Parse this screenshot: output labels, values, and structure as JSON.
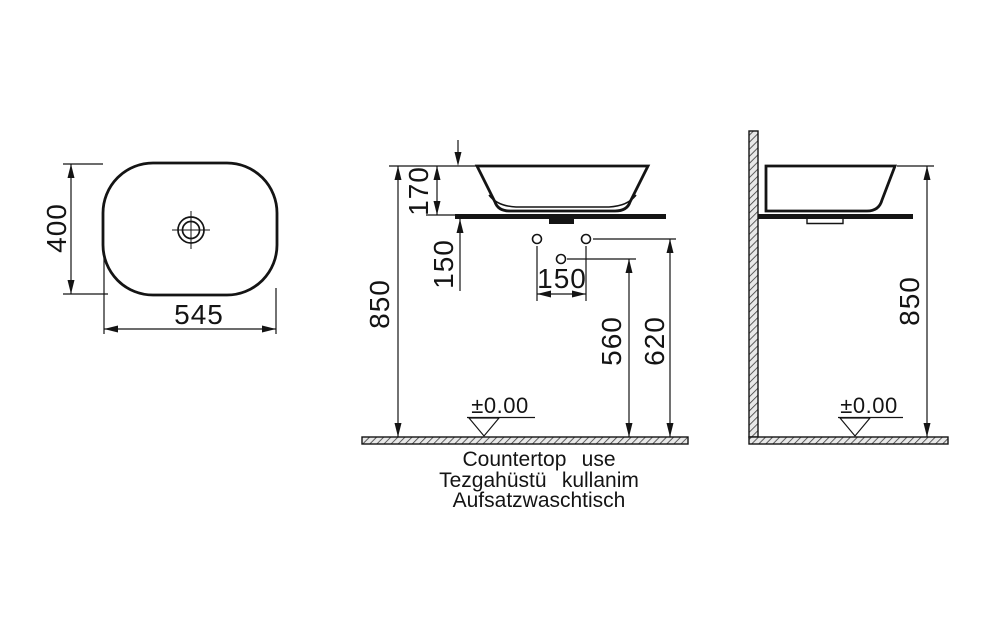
{
  "drawing": {
    "background": "#ffffff",
    "line_color": "#141414",
    "views": {
      "top": {
        "width": "545",
        "height": "400"
      },
      "front": {
        "rim_height": "170",
        "floor_to_rim": "850",
        "countertop_to_hole": "150",
        "hole_spacing": "150",
        "floor_to_drain_hole": "560",
        "floor_to_supply_holes": "620",
        "datum": "±0.00"
      },
      "side": {
        "floor_to_rim": "850",
        "datum": "±0.00"
      }
    },
    "caption_lines": [
      "Countertop use",
      "Tezgahüstü kullanim",
      "Aufsatzwaschtisch"
    ]
  }
}
